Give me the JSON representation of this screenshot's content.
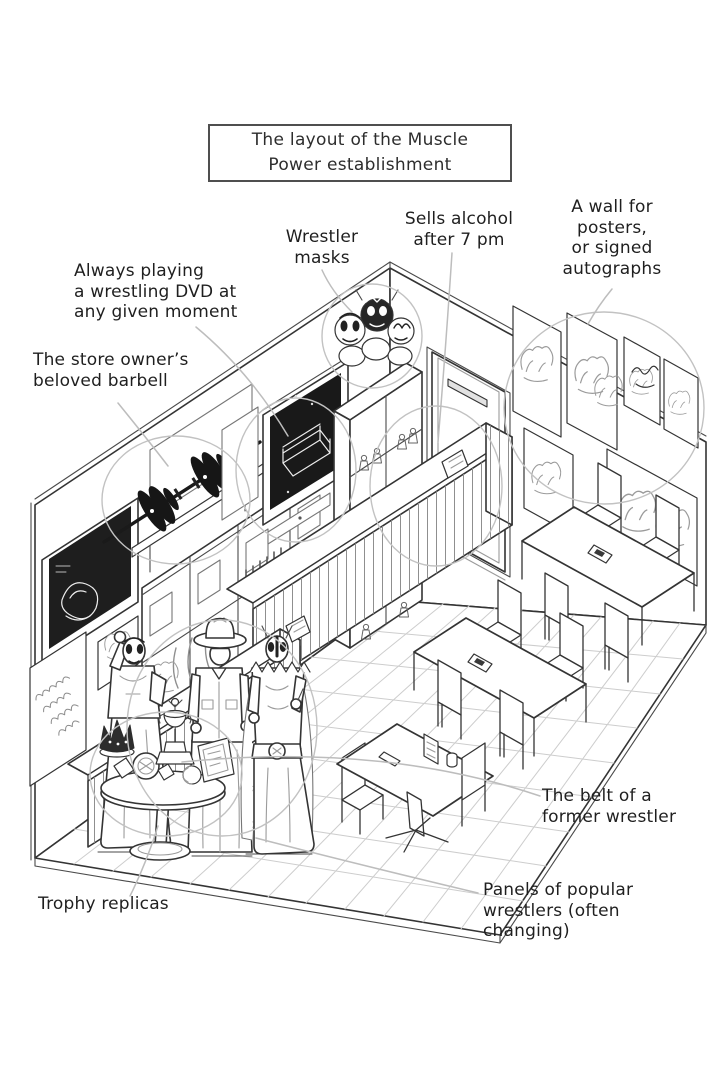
{
  "title_box": {
    "text": "The layout of the Muscle\nPower establishment"
  },
  "labels": {
    "dvd": "Always playing\na wrestling DVD at\nany given moment",
    "masks": "Wrestler\nmasks",
    "alcohol": "Sells alcohol\nafter 7 pm",
    "poster_wall": "A wall for\nposters,\nor signed\nautographs",
    "barbell": "The store owner’s\nbeloved barbell",
    "belt": "The belt of a\nformer wrestler",
    "panels": "Panels of popular\nwrestlers (often\nchanging)",
    "trophies": "Trophy replicas"
  },
  "illustration": {
    "style": "black-and-white manga line art, isometric cutaway of the store",
    "features": [
      "TV on left wall playing a wrestling DVD",
      "wrestler masks piled on top of a figure bookshelf",
      "bookshelf with wrestler figures in cubbies",
      "store owner's barbell displayed on a wall shelf",
      "back door",
      "right wall with six framed posters and autographs",
      "long slatted bar counter with small sign",
      "low slatted merchandise counter with small sign",
      "two four-seat tables with high-back chairs",
      "one small two-seat pedestal table with menu stand",
      "three life-size wrestler standee panels",
      "round pedestal table with trophy replicas, crown, plaque and a championship belt",
      "tiled floor grid"
    ]
  },
  "colors": {
    "ink": "#343434",
    "annotation_gray": "#c2c2c2",
    "grid_gray": "#cdcdcd",
    "dark_fill": "#1e1e1e",
    "background": "#ffffff"
  }
}
